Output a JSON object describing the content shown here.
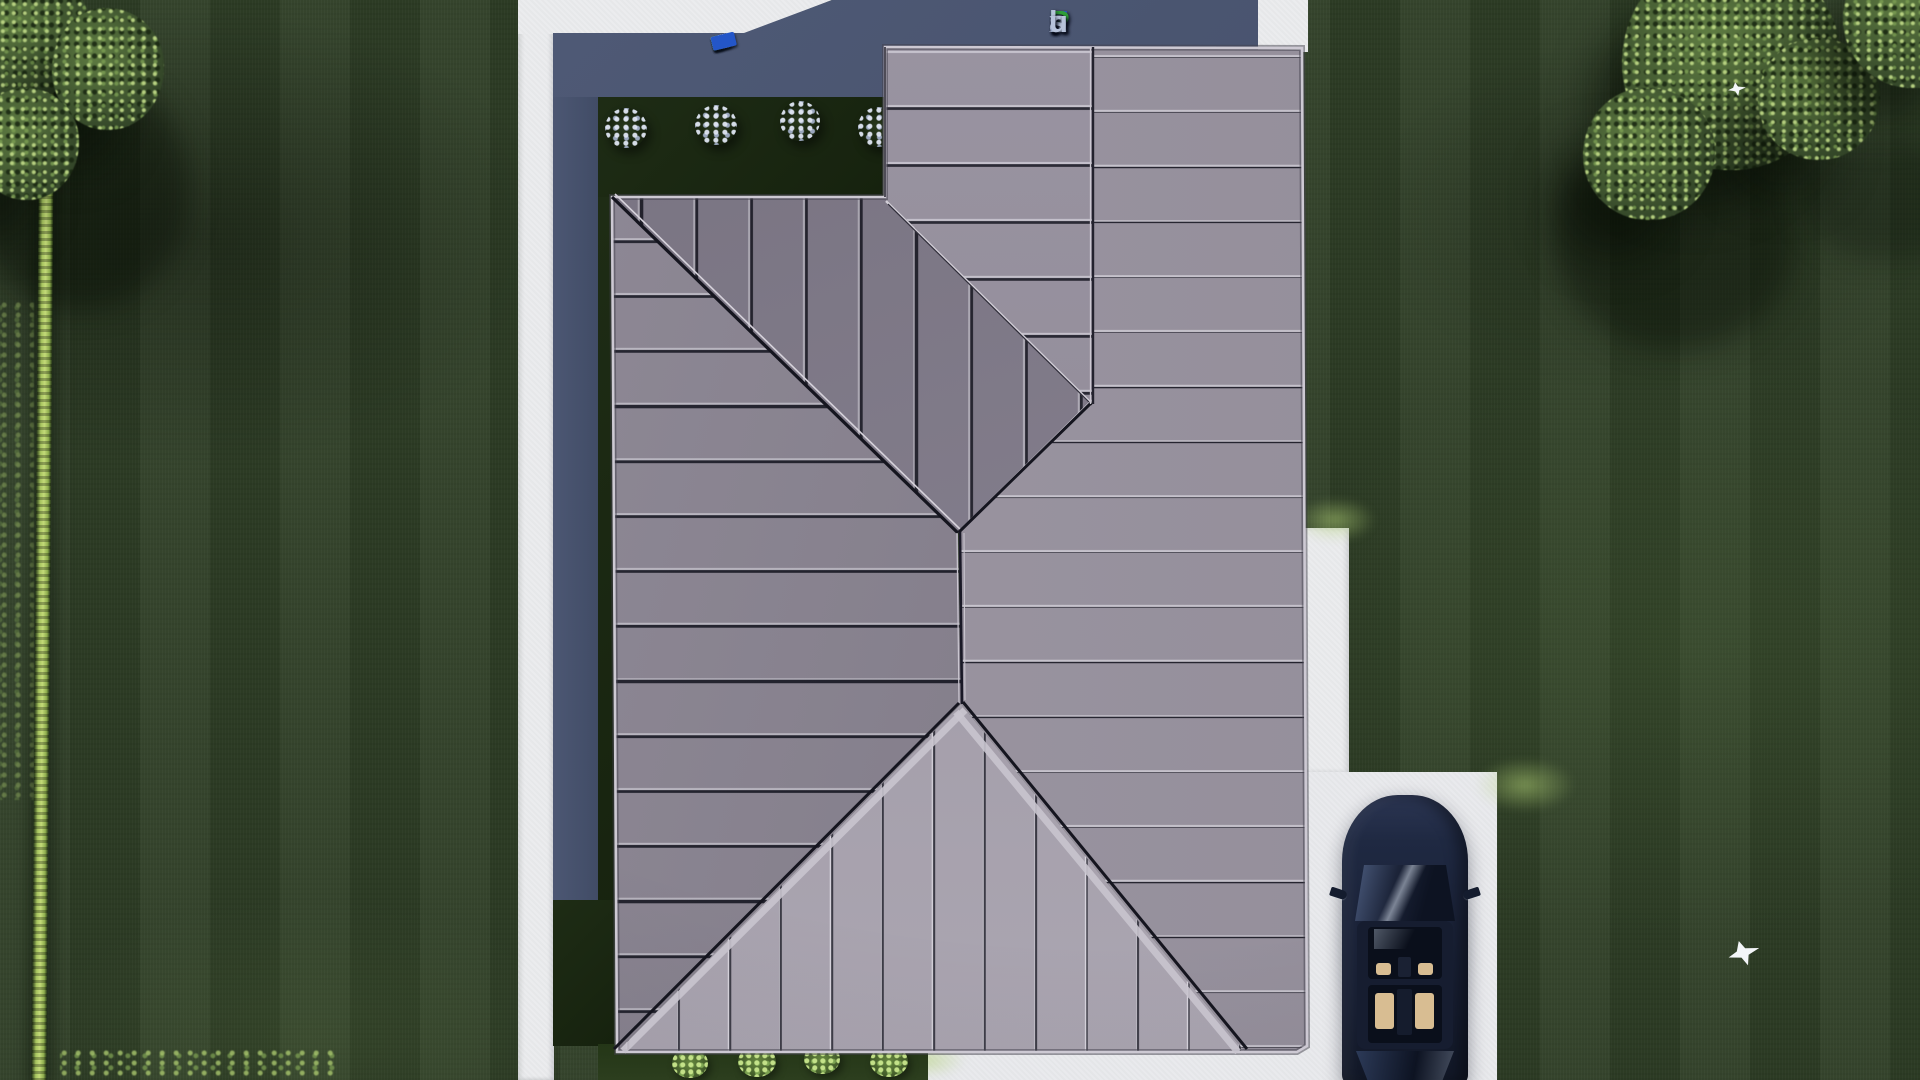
{
  "scene": {
    "description": "Aerial top-down 3D render of a house standing-seam metal roof with lawn, hedge, trees, walkways, driveway and a parked sedan",
    "watermark": {
      "text": "FixPlans.ru",
      "segments": [
        {
          "ch": "F",
          "color": "#2c5bd4"
        },
        {
          "ch": "i",
          "color": "#2f9e38"
        },
        {
          "ch": "x",
          "color": "#b6c2da"
        },
        {
          "ch": "P",
          "color": "#2f9e38"
        },
        {
          "ch": "l",
          "color": "#b6c2da"
        },
        {
          "ch": "a",
          "color": "#b6c2da"
        },
        {
          "ch": "n",
          "color": "#b6c2da"
        },
        {
          "ch": "s",
          "color": "#b6c2da"
        },
        {
          "ch": ".",
          "color": "#2c5bd4"
        },
        {
          "ch": "r",
          "color": "#b6c2da"
        },
        {
          "ch": "u",
          "color": "#b6c2da"
        }
      ]
    },
    "logo_strip_blocks": [
      {
        "w": 14,
        "color": "#eef1f6"
      },
      {
        "w": 22,
        "color": "#dfe6ef"
      },
      {
        "w": 9,
        "color": "#2456c8"
      },
      {
        "w": 18,
        "color": "#eef1f6"
      },
      {
        "w": 10,
        "color": "#2f9e38"
      },
      {
        "w": 16,
        "color": "#e6ebf2"
      },
      {
        "w": 18,
        "color": "#eef1f6"
      },
      {
        "w": 9,
        "color": "#2f9e38"
      },
      {
        "w": 24,
        "color": "#2456c8"
      }
    ],
    "objects": {
      "roof": {
        "material": "standing-seam metal, gray",
        "color": "#9a949c",
        "planes": [
          "left",
          "north-center",
          "top-center",
          "right",
          "south-gable-triangle"
        ]
      },
      "car": {
        "label": "dark navy sedan parked on driveway, top view",
        "body_color": "#1c2537",
        "glass_color": "#0d1322",
        "seat_color": "#d8bd92"
      },
      "hedge": {
        "label": "trimmed bright hedge line along left lawn",
        "color": "#a6c45e"
      },
      "trees": {
        "top_right_cluster": 3,
        "top_left_cluster": 3
      },
      "birds": [
        {
          "label": "white bird on lawn"
        },
        {
          "label": "white bird on tree"
        }
      ],
      "garden": {
        "flower_bushes": 4,
        "green_bushes": 4
      },
      "paths": {
        "color": "#ebecee",
        "areas": [
          "left walkway",
          "top walkway",
          "right walkway",
          "driveway"
        ]
      },
      "terrace_color": "#49546f",
      "lawn_color": "#2e3d26"
    }
  }
}
